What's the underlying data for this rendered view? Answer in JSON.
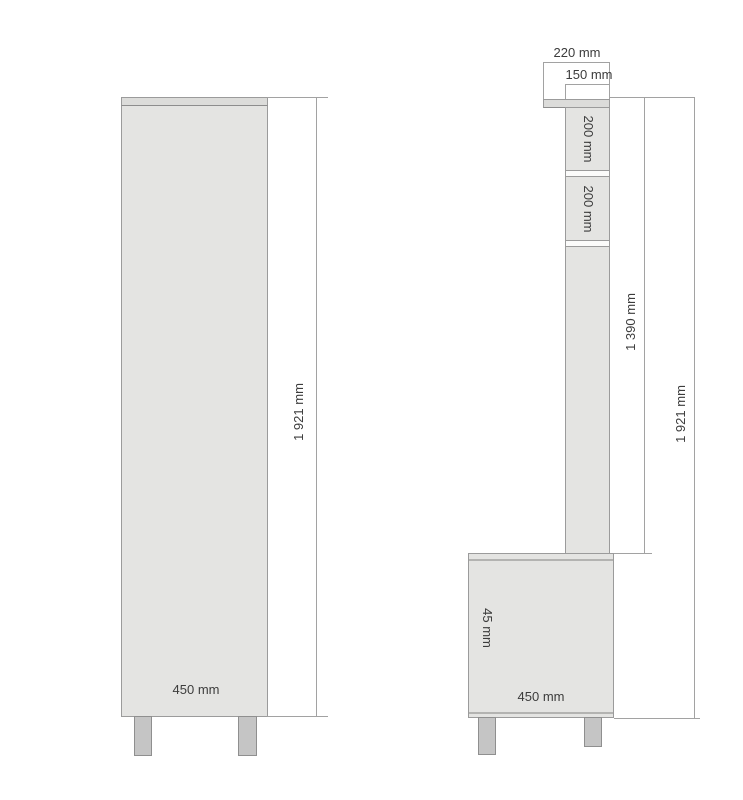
{
  "drawing": {
    "front_view": {
      "width_label": "450 mm",
      "height_label": "1 921 mm"
    },
    "side_view": {
      "top_depth_label": "220 mm",
      "upper_depth_label": "150 mm",
      "shelf_section_labels": [
        "200 mm",
        "200 mm"
      ],
      "mid_height_label": "1 390 mm",
      "total_height_label": "1 921 mm",
      "base_height_label": "45 mm",
      "base_depth_label": "450 mm"
    },
    "colors": {
      "background": "#ffffff",
      "panel_fill": "#e4e4e2",
      "panel_edge": "#9b9b9b",
      "top_rail_fill": "#dcdcda",
      "divider_fill": "#fbfbfa",
      "dimension_line": "#a2a2a2",
      "leg_fill": "#c5c5c5",
      "label_text": "#3c3c3c"
    }
  }
}
